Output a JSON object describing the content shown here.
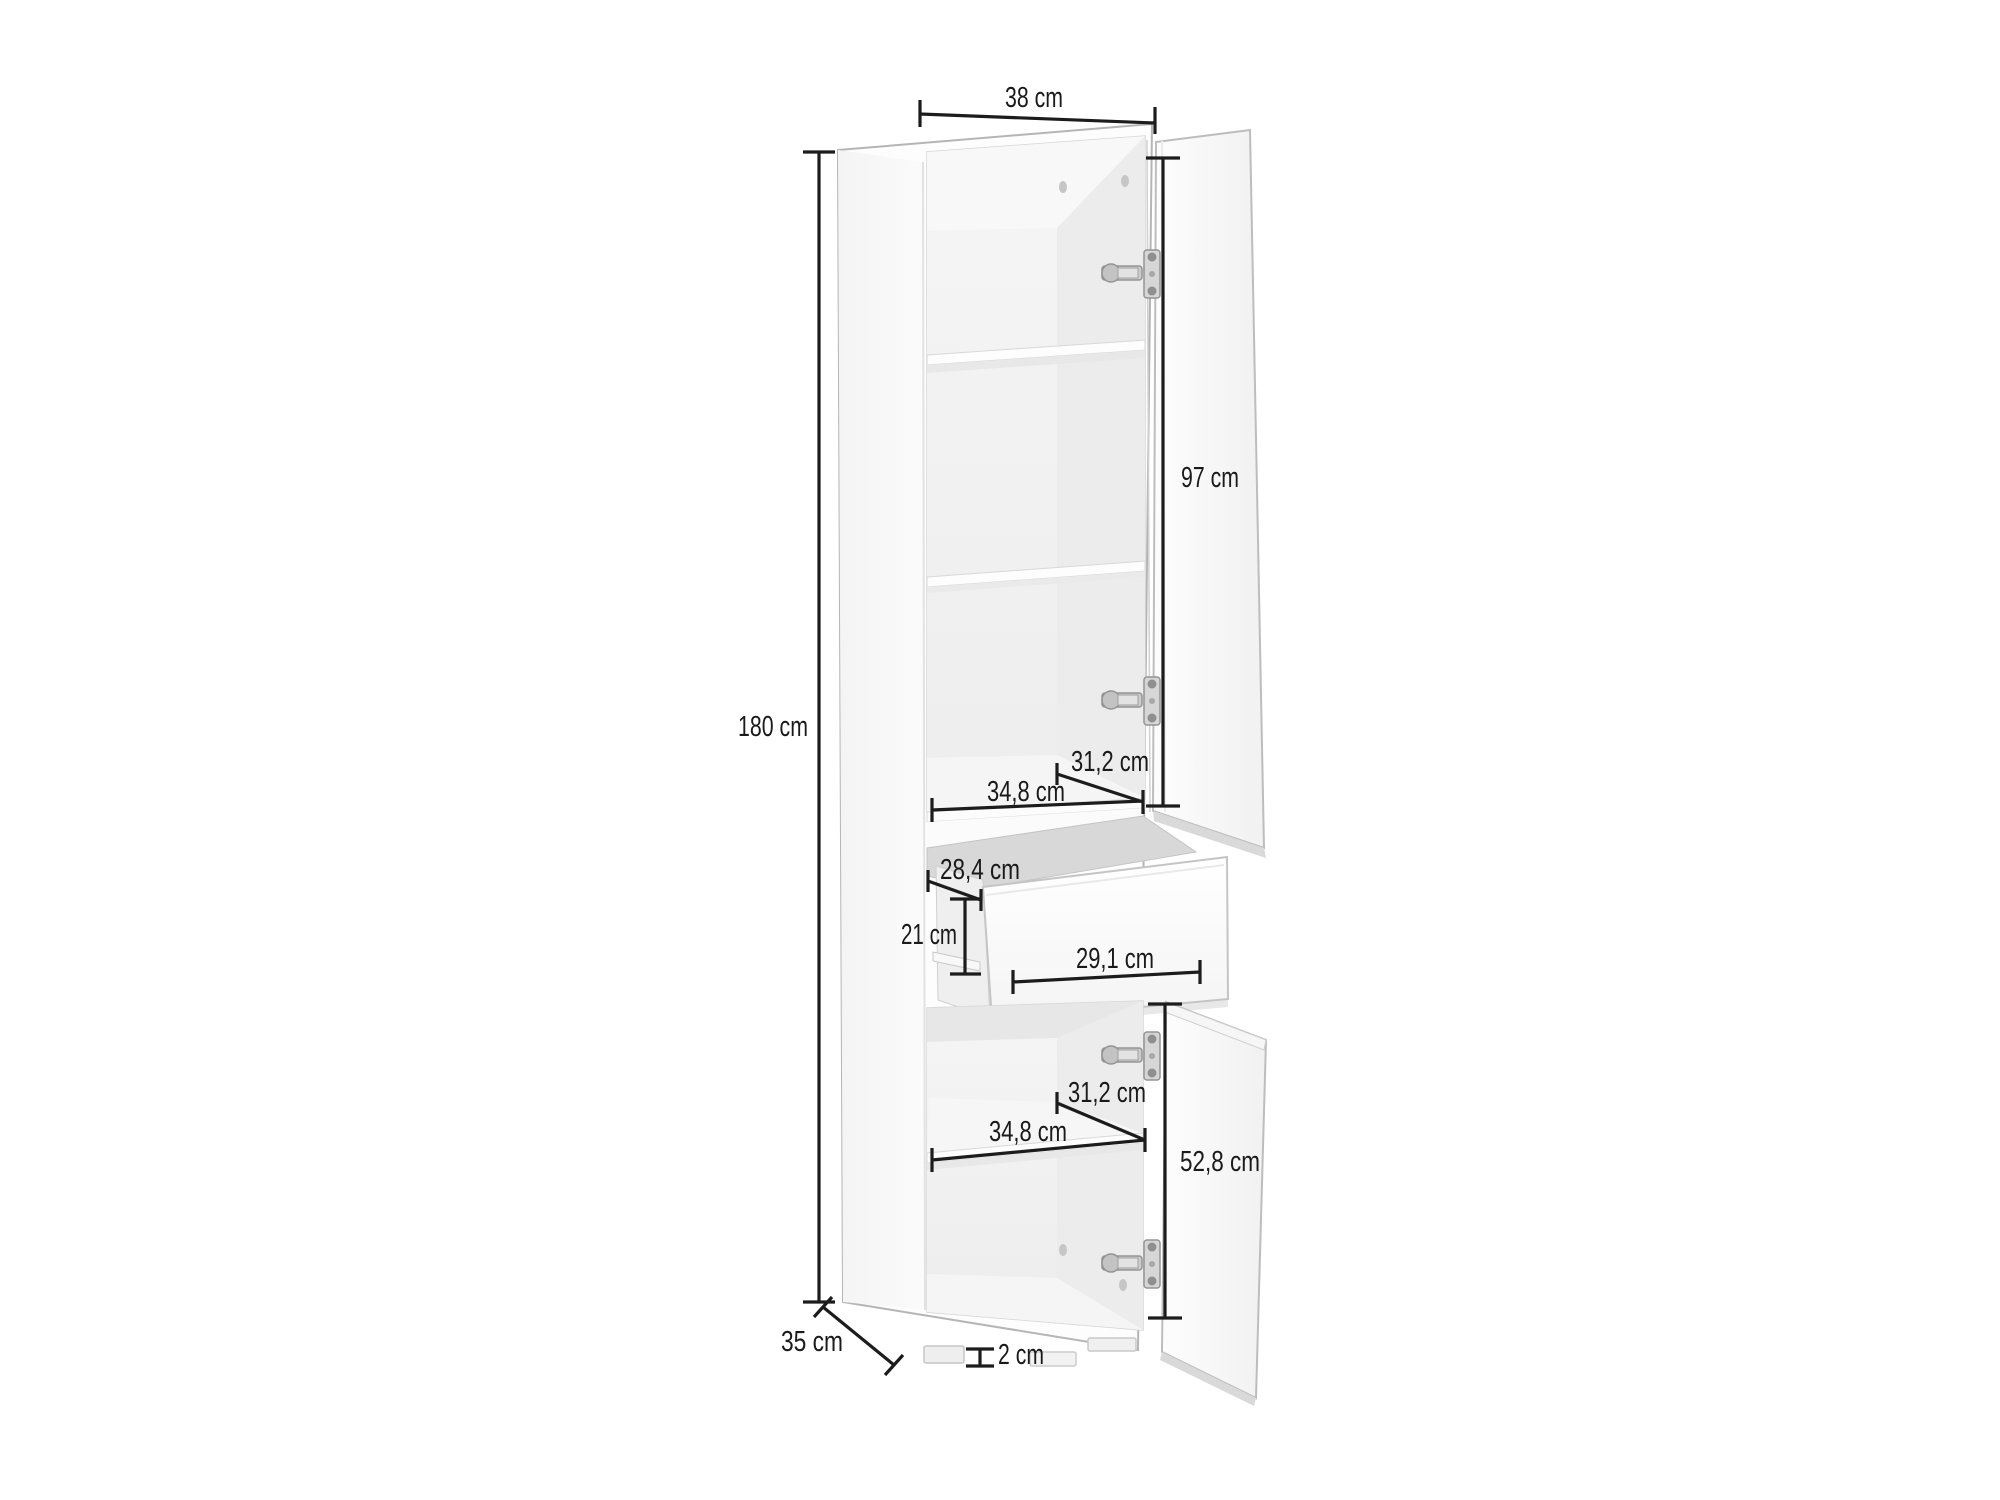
{
  "diagram": {
    "kind": "furniture-dimension-diagram",
    "subject": "Tall storage cabinet with open doors, pulled-out drawer, shelves and feet",
    "unit": "cm",
    "line_color": "#1c1c1c",
    "background": "#ffffff"
  },
  "dimensions": {
    "cabinet_width": {
      "label": "38 cm"
    },
    "cabinet_height": {
      "label": "180 cm"
    },
    "cabinet_depth": {
      "label": "35 cm"
    },
    "upper_door_height": {
      "label": "97 cm"
    },
    "upper_interior_depth": {
      "label": "31,2 cm"
    },
    "upper_interior_width": {
      "label": "34,8 cm"
    },
    "drawer_interior_depth": {
      "label": "28,4 cm"
    },
    "drawer_opening_height": {
      "label": "21 cm"
    },
    "drawer_front_width": {
      "label": "29,1 cm"
    },
    "lower_interior_depth": {
      "label": "31,2 cm"
    },
    "lower_interior_width": {
      "label": "34,8 cm"
    },
    "lower_door_height": {
      "label": "52,8 cm"
    },
    "foot_height": {
      "label": "2 cm"
    }
  }
}
